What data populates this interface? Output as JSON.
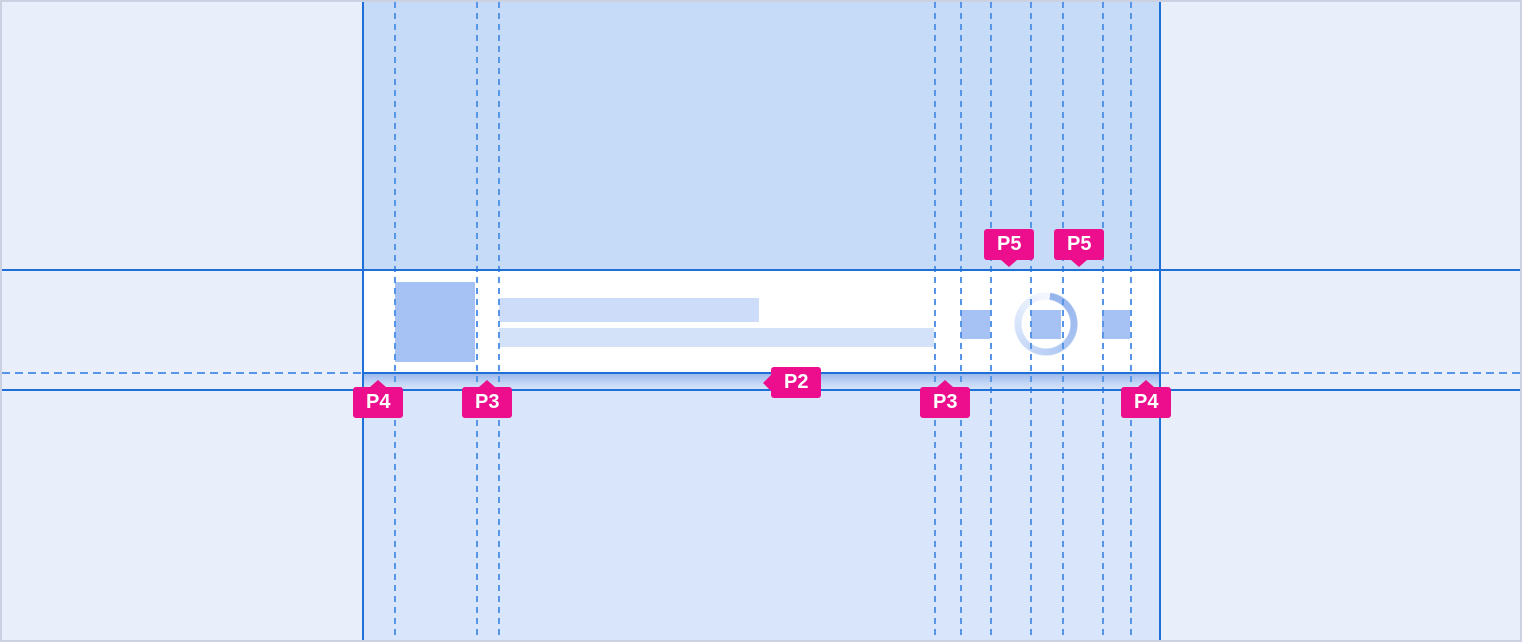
{
  "page": {
    "title": "List row spacing redline specification",
    "kind": "design-spec-overlay"
  },
  "annotations": [
    {
      "label": "P5",
      "target": "gap-between-action-icon-1-and-2"
    },
    {
      "label": "P5",
      "target": "gap-between-action-icon-2-and-3"
    },
    {
      "label": "P2",
      "target": "row-bottom-spacing"
    },
    {
      "label": "P4",
      "target": "container-left-inset"
    },
    {
      "label": "P3",
      "target": "avatar-to-text-gap"
    },
    {
      "label": "P3",
      "target": "text-to-actions-gap"
    },
    {
      "label": "P4",
      "target": "container-right-inset"
    }
  ],
  "colors": {
    "annotation_pink": "#EC0E8C",
    "guide_blue_solid": "#1E70D8",
    "guide_blue_dashed": "#5795E7",
    "column_overlay_top": "#C6DBF8",
    "column_overlay_bottom": "#D8E5FA",
    "canvas_background": "#E9EEFB",
    "placeholder_fill": "#A6C2F4",
    "title_line_fill": "#CDDDF9",
    "subtitle_line_fill": "#D4E2F9",
    "row_background": "#FFFFFF"
  }
}
